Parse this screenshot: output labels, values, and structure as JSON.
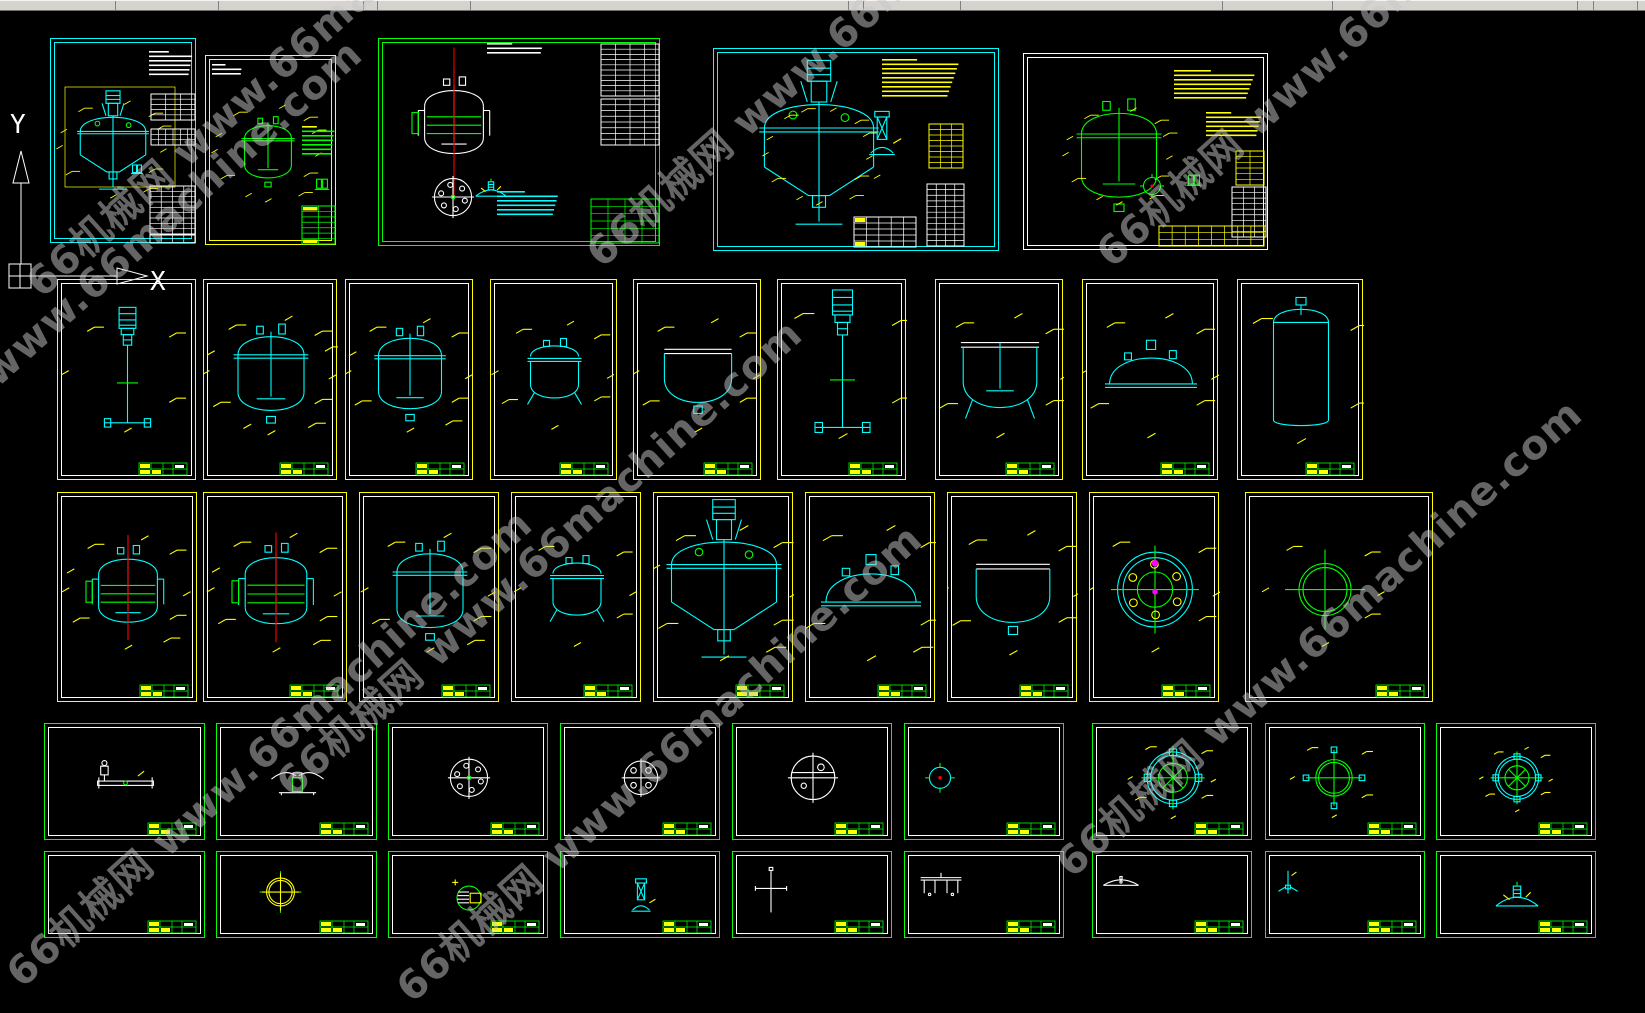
{
  "app": {
    "description": "CAD model space with reactor drawing sheets",
    "background": "#000000"
  },
  "topbar": {
    "color": "#d6d3ce",
    "height": 10,
    "separators": [
      115,
      218,
      363,
      377,
      470,
      848,
      863,
      960,
      1222,
      1332,
      1577,
      1593,
      1637
    ]
  },
  "watermark": {
    "text": "66机械网 www.66machine.com",
    "color": "#c9c9c9",
    "opacity": 0.5,
    "font_size": 40,
    "rotation_deg": -42,
    "instances": [
      {
        "x": 50,
        "y": 300
      },
      {
        "x": 610,
        "y": 270
      },
      {
        "x": 1120,
        "y": 270
      },
      {
        "x": -140,
        "y": 520
      },
      {
        "x": 300,
        "y": 800
      },
      {
        "x": 30,
        "y": 990
      },
      {
        "x": 420,
        "y": 1005
      },
      {
        "x": 1080,
        "y": 880
      }
    ]
  },
  "ucs": {
    "x_label": "X",
    "y_label": "Y",
    "color": "#ffffff"
  },
  "palette": {
    "cyan": "#00ffff",
    "yellow": "#ffff00",
    "green": "#00ff00",
    "white": "#ffffff",
    "red": "#ff0000",
    "magenta": "#ff00ff"
  },
  "frames": [
    {
      "id": "A1",
      "x": 50,
      "y": 38,
      "w": 146,
      "h": 205,
      "border": "#00ffff",
      "inner": "#00ffff",
      "mini": false,
      "features": [
        {
          "t": "lines",
          "x": 98,
          "y": 12,
          "w": 44,
          "n": 6,
          "c": "#ffffff"
        },
        {
          "t": "dimrect",
          "x": 14,
          "y": 48,
          "w": 110,
          "h": 100,
          "c": "#ffff00"
        },
        {
          "t": "glyph",
          "g": "reactor",
          "cx": 62,
          "cy": 108,
          "s": 0.78,
          "c": "#00ffff"
        },
        {
          "t": "ticks",
          "cx": 62,
          "cy": 108,
          "r": 52,
          "n": 11,
          "c": "#ffff00"
        },
        {
          "t": "glyph",
          "g": "valve",
          "cx": 86,
          "cy": 130,
          "s": 0.5,
          "c": "#00ffff"
        },
        {
          "t": "table",
          "x": 100,
          "y": 55,
          "w": 44,
          "h": 26,
          "r": 5,
          "col": 3,
          "c": "#ffffff"
        },
        {
          "t": "table",
          "x": 100,
          "y": 90,
          "w": 44,
          "h": 16,
          "r": 3,
          "col": 6,
          "c": "#ffffff"
        },
        {
          "t": "table",
          "x": 99,
          "y": 147,
          "w": 45,
          "h": 48,
          "r": 9,
          "col": 4,
          "c": "#ffffff"
        },
        {
          "t": "table",
          "x": 99,
          "y": 196,
          "w": 45,
          "h": 8,
          "r": 1,
          "col": 4,
          "c": "#ffffff"
        }
      ]
    },
    {
      "id": "A2",
      "x": 205,
      "y": 55,
      "w": 131,
      "h": 190,
      "border": "#ffff00",
      "inner": "#ffff00",
      "mini": false,
      "features": [
        {
          "t": "lines",
          "x": 6,
          "y": 8,
          "w": 30,
          "n": 3,
          "c": "#ffffff"
        },
        {
          "t": "glyph",
          "g": "vessel2",
          "cx": 62,
          "cy": 95,
          "s": 0.78,
          "c": "#00ff00"
        },
        {
          "t": "ticks",
          "cx": 62,
          "cy": 95,
          "r": 46,
          "n": 12,
          "c": "#00ff00"
        },
        {
          "t": "lines",
          "x": 96,
          "y": 70,
          "w": 33,
          "n": 7,
          "c": "#00ff00",
          "first": "#ffff00"
        },
        {
          "t": "glyph",
          "g": "valve",
          "cx": 116,
          "cy": 128,
          "s": 0.6,
          "c": "#00ff00"
        },
        {
          "t": "table",
          "x": 96,
          "y": 150,
          "w": 33,
          "h": 38,
          "r": 7,
          "col": 2,
          "c": "#00ff00",
          "acc": "#ffff00"
        }
      ]
    },
    {
      "id": "A3",
      "x": 378,
      "y": 38,
      "w": 282,
      "h": 208,
      "border": "#00ff00",
      "inner": "#00ff00",
      "mini": false,
      "features": [
        {
          "t": "lines",
          "x": 108,
          "y": 4,
          "w": 56,
          "n": 3,
          "c": "#ffffff"
        },
        {
          "t": "glyph",
          "g": "jacketed",
          "cx": 75,
          "cy": 82,
          "s": 1.05,
          "c": "#ffffff",
          "red": 1
        },
        {
          "t": "glyph",
          "g": "boltcircle",
          "cx": 74,
          "cy": 158,
          "s": 0.62,
          "c": "#ffffff"
        },
        {
          "t": "glyph",
          "g": "clamp",
          "cx": 112,
          "cy": 150,
          "s": 0.45,
          "c": "#00ffff"
        },
        {
          "t": "table",
          "x": 222,
          "y": 5,
          "w": 58,
          "h": 52,
          "r": 10,
          "col": 4,
          "c": "#ffffff"
        },
        {
          "t": "table",
          "x": 222,
          "y": 60,
          "w": 58,
          "h": 46,
          "r": 8,
          "col": 4,
          "c": "#ffffff"
        },
        {
          "t": "lines",
          "x": 118,
          "y": 152,
          "w": 62,
          "n": 6,
          "c": "#00ffff"
        },
        {
          "t": "table",
          "x": 212,
          "y": 160,
          "w": 68,
          "h": 44,
          "r": 6,
          "col": 4,
          "c": "#00ff00"
        }
      ]
    },
    {
      "id": "A4",
      "x": 713,
      "y": 48,
      "w": 286,
      "h": 203,
      "border": "#00ffff",
      "inner": "#00ffff",
      "mini": false,
      "features": [
        {
          "t": "glyph",
          "g": "reactor",
          "cx": 105,
          "cy": 105,
          "s": 1.3,
          "c": "#00ffff"
        },
        {
          "t": "ticks",
          "cx": 105,
          "cy": 105,
          "r": 82,
          "n": 14,
          "c": "#ffff00"
        },
        {
          "t": "glyph",
          "g": "column",
          "cx": 168,
          "cy": 88,
          "s": 0.8,
          "c": "#00ffff"
        },
        {
          "t": "lines",
          "x": 168,
          "y": 10,
          "w": 78,
          "n": 9,
          "c": "#ffff00"
        },
        {
          "t": "table",
          "x": 215,
          "y": 75,
          "w": 34,
          "h": 44,
          "r": 8,
          "col": 3,
          "c": "#ffff00"
        },
        {
          "t": "table",
          "x": 213,
          "y": 135,
          "w": 37,
          "h": 62,
          "r": 11,
          "col": 4,
          "c": "#ffffff"
        },
        {
          "t": "table",
          "x": 140,
          "y": 168,
          "w": 62,
          "h": 30,
          "r": 5,
          "col": 5,
          "c": "#ffffff",
          "acc": "#ffff00"
        }
      ]
    },
    {
      "id": "A5",
      "x": 1023,
      "y": 53,
      "w": 245,
      "h": 197,
      "border": "#ffffff",
      "inner": "#ffffff",
      "mini": false,
      "features": [
        {
          "t": "glyph",
          "g": "vessel2",
          "cx": 95,
          "cy": 100,
          "s": 1.25,
          "c": "#00ff00"
        },
        {
          "t": "ticks",
          "cx": 95,
          "cy": 100,
          "r": 72,
          "n": 12,
          "c": "#ffff00"
        },
        {
          "t": "lines",
          "x": 150,
          "y": 16,
          "w": 82,
          "n": 7,
          "c": "#ffff00"
        },
        {
          "t": "lines",
          "x": 182,
          "y": 58,
          "w": 56,
          "n": 6,
          "c": "#ffff00"
        },
        {
          "t": "glyph",
          "g": "smallcircle",
          "cx": 128,
          "cy": 132,
          "s": 0.5,
          "c": "#00ff00"
        },
        {
          "t": "glyph",
          "g": "valve",
          "cx": 170,
          "cy": 126,
          "s": 0.6,
          "c": "#00ff00"
        },
        {
          "t": "table",
          "x": 212,
          "y": 97,
          "w": 28,
          "h": 34,
          "r": 6,
          "col": 2,
          "c": "#ffff00"
        },
        {
          "t": "table",
          "x": 208,
          "y": 133,
          "w": 34,
          "h": 50,
          "r": 9,
          "col": 3,
          "c": "#ffffff"
        },
        {
          "t": "table",
          "x": 135,
          "y": 172,
          "w": 105,
          "h": 20,
          "r": 3,
          "col": 8,
          "c": "#ffff00"
        }
      ]
    },
    {
      "id": "B1",
      "x": 57,
      "y": 279,
      "w": 139,
      "h": 201,
      "border": "#ffff00",
      "inner": "#ffffff",
      "mini": true,
      "content": {
        "type": "agitator",
        "color": "#00ffff",
        "s": 1.05,
        "ticks": 5
      }
    },
    {
      "id": "B2",
      "x": 203,
      "y": 279,
      "w": 134,
      "h": 201,
      "border": "#ffff00",
      "inner": "#ffffff",
      "mini": true,
      "content": {
        "type": "vessel2",
        "color": "#00ffff",
        "s": 1.1,
        "ticks": 12
      }
    },
    {
      "id": "B3",
      "x": 345,
      "y": 279,
      "w": 128,
      "h": 201,
      "border": "#ffff00",
      "inner": "#ffffff",
      "mini": true,
      "content": {
        "type": "vessel2",
        "color": "#00ffff",
        "s": 1.05,
        "ticks": 10
      }
    },
    {
      "id": "B4",
      "x": 490,
      "y": 279,
      "w": 127,
      "h": 201,
      "border": "#ffff00",
      "inner": "#ffffff",
      "mini": true,
      "content": {
        "type": "pot",
        "color": "#00ffff",
        "s": 1.0,
        "ticks": 8
      }
    },
    {
      "id": "B5",
      "x": 633,
      "y": 279,
      "w": 128,
      "h": 201,
      "border": "#ffff00",
      "inner": "#ffffff",
      "mini": true,
      "content": {
        "type": "openvessel",
        "color": "#00ffff",
        "s": 1.05,
        "ticks": 8
      }
    },
    {
      "id": "B6",
      "x": 777,
      "y": 279,
      "w": 129,
      "h": 201,
      "border": "#ffff00",
      "inner": "#ffffff",
      "mini": true,
      "content": {
        "type": "agitator",
        "color": "#00ffff",
        "s": 1.25,
        "ticks": 6,
        "dy": -5
      }
    },
    {
      "id": "B7",
      "x": 935,
      "y": 279,
      "w": 128,
      "h": 201,
      "border": "#ffff00",
      "inner": "#ffffff",
      "mini": true,
      "content": {
        "type": "tank",
        "color": "#00ffff",
        "s": 1.15,
        "ticks": 8
      }
    },
    {
      "id": "B8",
      "x": 1082,
      "y": 279,
      "w": 136,
      "h": 201,
      "border": "#ffff00",
      "inner": "#ffffff",
      "mini": true,
      "content": {
        "type": "head",
        "color": "#00ffff",
        "s": 1.15,
        "ticks": 8
      }
    },
    {
      "id": "B9",
      "x": 1237,
      "y": 279,
      "w": 126,
      "h": 201,
      "border": "#ffff00",
      "inner": "#ffffff",
      "mini": true,
      "content": {
        "type": "cyl",
        "color": "#00ffff",
        "s": 1.25,
        "ticks": 6
      }
    },
    {
      "id": "C1",
      "x": 57,
      "y": 492,
      "w": 140,
      "h": 210,
      "border": "#ffff00",
      "inner": "#ffffff",
      "mini": true,
      "content": {
        "type": "jacketed",
        "color": "#00ffff",
        "s": 1.05,
        "ticks": 10,
        "red": 1
      }
    },
    {
      "id": "C2",
      "x": 203,
      "y": 492,
      "w": 144,
      "h": 210,
      "border": "#ffff00",
      "inner": "#ffffff",
      "mini": true,
      "content": {
        "type": "jacketed",
        "color": "#00ffff",
        "s": 1.1,
        "ticks": 10,
        "red": 1
      }
    },
    {
      "id": "C3",
      "x": 359,
      "y": 492,
      "w": 140,
      "h": 210,
      "border": "#ffff00",
      "inner": "#ffffff",
      "mini": true,
      "content": {
        "type": "vessel2",
        "color": "#00ffff",
        "s": 1.1,
        "ticks": 9,
        "red": 1
      }
    },
    {
      "id": "C4",
      "x": 511,
      "y": 492,
      "w": 130,
      "h": 210,
      "border": "#ffff00",
      "inner": "#ffffff",
      "mini": true,
      "content": {
        "type": "pot",
        "color": "#00ffff",
        "s": 1.0,
        "ticks": 6,
        "red": 1
      }
    },
    {
      "id": "C5",
      "x": 653,
      "y": 492,
      "w": 140,
      "h": 210,
      "border": "#ffff00",
      "inner": "#ffffff",
      "mini": true,
      "content": {
        "type": "reactor",
        "color": "#00ffff",
        "s": 1.25,
        "ticks": 10
      }
    },
    {
      "id": "C6",
      "x": 805,
      "y": 492,
      "w": 130,
      "h": 210,
      "border": "#ffff00",
      "inner": "#ffffff",
      "mini": true,
      "content": {
        "type": "head",
        "color": "#00ffff",
        "s": 1.25,
        "ticks": 9
      }
    },
    {
      "id": "C7",
      "x": 947,
      "y": 492,
      "w": 130,
      "h": 210,
      "border": "#ffff00",
      "inner": "#ffffff",
      "mini": true,
      "content": {
        "type": "openvessel",
        "color": "#00ffff",
        "s": 1.15,
        "ticks": 8
      }
    },
    {
      "id": "C8",
      "x": 1089,
      "y": 492,
      "w": 130,
      "h": 210,
      "border": "#ffff00",
      "inner": "#ffffff",
      "mini": true,
      "content": {
        "type": "boltflange",
        "color": "#00ffff",
        "s": 1.1,
        "ticks": 6
      }
    },
    {
      "id": "C9",
      "x": 1245,
      "y": 492,
      "w": 188,
      "h": 210,
      "border": "#ffff00",
      "inner": "#ffffff",
      "mini": true,
      "content": {
        "type": "crosscircle",
        "color": "#00ff00",
        "s": 1.0,
        "ticks": 6,
        "dx": -15
      }
    },
    {
      "id": "D1",
      "x": 44,
      "y": 723,
      "w": 161,
      "h": 117,
      "border": "#00ff00",
      "inner": "#ffffff",
      "mini": true,
      "content": {
        "type": "lyingagit",
        "color": "#ffffff",
        "s": 0.62,
        "dy": 2
      }
    },
    {
      "id": "D2",
      "x": 216,
      "y": 723,
      "w": 161,
      "h": 117,
      "border": "#00ff00",
      "inner": "#ffffff",
      "mini": true,
      "content": {
        "type": "impellerside",
        "color": "#ffffff",
        "s": 0.62
      }
    },
    {
      "id": "D3",
      "x": 388,
      "y": 723,
      "w": 160,
      "h": 117,
      "border": "#00ff00",
      "inner": "#ffffff",
      "mini": true,
      "content": {
        "type": "boltcircle",
        "color": "#ffffff",
        "s": 0.62
      }
    },
    {
      "id": "D4",
      "x": 560,
      "y": 723,
      "w": 160,
      "h": 117,
      "border": "#00ff00",
      "inner": "#ffffff",
      "mini": true,
      "content": {
        "type": "boltcircle4",
        "color": "#ffffff",
        "s": 0.62
      }
    },
    {
      "id": "D5",
      "x": 732,
      "y": 723,
      "w": 160,
      "h": 117,
      "border": "#00ff00",
      "inner": "#ffffff",
      "mini": true,
      "content": {
        "type": "bigcircle",
        "color": "#ffffff",
        "s": 0.66
      }
    },
    {
      "id": "D6",
      "x": 904,
      "y": 723,
      "w": 160,
      "h": 117,
      "border": "#00ff00",
      "inner": "#ffffff",
      "mini": true,
      "content": {
        "type": "smallcircle",
        "color": "#00ffff",
        "s": 0.62,
        "dx": -45
      }
    },
    {
      "id": "D7",
      "x": 1092,
      "y": 723,
      "w": 160,
      "h": 117,
      "border": "#00ff00",
      "inner": "#ffffff",
      "mini": true,
      "content": {
        "type": "flange2",
        "color": "#00ffff",
        "s": 0.72,
        "ticks": 7
      }
    },
    {
      "id": "D8",
      "x": 1265,
      "y": 723,
      "w": 160,
      "h": 117,
      "border": "#00ff00",
      "inner": "#ffffff",
      "mini": true,
      "content": {
        "type": "crosscircle",
        "color": "#00ff00",
        "s": 0.7,
        "stubs": 1,
        "dx": -12,
        "ticks": 5
      }
    },
    {
      "id": "D9",
      "x": 1436,
      "y": 723,
      "w": 160,
      "h": 117,
      "border": "#00ff00",
      "inner": "#ffffff",
      "mini": true,
      "content": {
        "type": "flange2",
        "color": "#00ffff",
        "s": 0.6,
        "ticks": 8
      }
    },
    {
      "id": "E1",
      "x": 44,
      "y": 851,
      "w": 161,
      "h": 87,
      "border": "#00ff00",
      "inner": "#ffffff",
      "mini": true,
      "content": {
        "type": "none",
        "color": "#00ff00",
        "s": 0.5
      }
    },
    {
      "id": "E2",
      "x": 216,
      "y": 851,
      "w": 161,
      "h": 87,
      "border": "#00ff00",
      "inner": "#ffffff",
      "mini": true,
      "content": {
        "type": "ringcross",
        "color": "#ffff00",
        "s": 0.58,
        "dx": -17
      }
    },
    {
      "id": "E3",
      "x": 388,
      "y": 851,
      "w": 160,
      "h": 87,
      "border": "#00ff00",
      "inner": "#ffffff",
      "mini": true,
      "content": {
        "type": "hatchcircle",
        "color": "#00ff00",
        "s": 0.6,
        "dy": 6
      }
    },
    {
      "id": "E4",
      "x": 560,
      "y": 851,
      "w": 160,
      "h": 87,
      "border": "#00ff00",
      "inner": "#ffffff",
      "mini": true,
      "content": {
        "type": "column",
        "color": "#00ffff",
        "s": 0.6,
        "dy": 6
      }
    },
    {
      "id": "E5",
      "x": 732,
      "y": 851,
      "w": 160,
      "h": 87,
      "border": "#00ff00",
      "inner": "#ffffff",
      "mini": true,
      "content": {
        "type": "vcross",
        "color": "#ffffff",
        "s": 0.6,
        "dx": -42
      }
    },
    {
      "id": "E6",
      "x": 904,
      "y": 851,
      "w": 160,
      "h": 87,
      "border": "#00ff00",
      "inner": "#ffffff",
      "mini": true,
      "content": {
        "type": "bench",
        "color": "#ffffff",
        "s": 0.6,
        "dx": -44,
        "dy": -6
      }
    },
    {
      "id": "E7",
      "x": 1092,
      "y": 851,
      "w": 160,
      "h": 87,
      "border": "#00ff00",
      "inner": "#ffffff",
      "mini": true,
      "content": {
        "type": "dish",
        "color": "#ffffff",
        "s": 0.55,
        "dx": -52,
        "dy": -10
      }
    },
    {
      "id": "E8",
      "x": 1265,
      "y": 851,
      "w": 160,
      "h": 87,
      "border": "#00ff00",
      "inner": "#ffffff",
      "mini": true,
      "content": {
        "type": "smallimp",
        "color": "#00ffff",
        "s": 0.6,
        "dx": -58,
        "dy": -8
      }
    },
    {
      "id": "E9",
      "x": 1436,
      "y": 851,
      "w": 160,
      "h": 87,
      "border": "#00ff00",
      "inner": "#ffffff",
      "mini": true,
      "content": {
        "type": "clamp",
        "color": "#00ffff",
        "s": 0.62,
        "dy": 4
      }
    }
  ]
}
